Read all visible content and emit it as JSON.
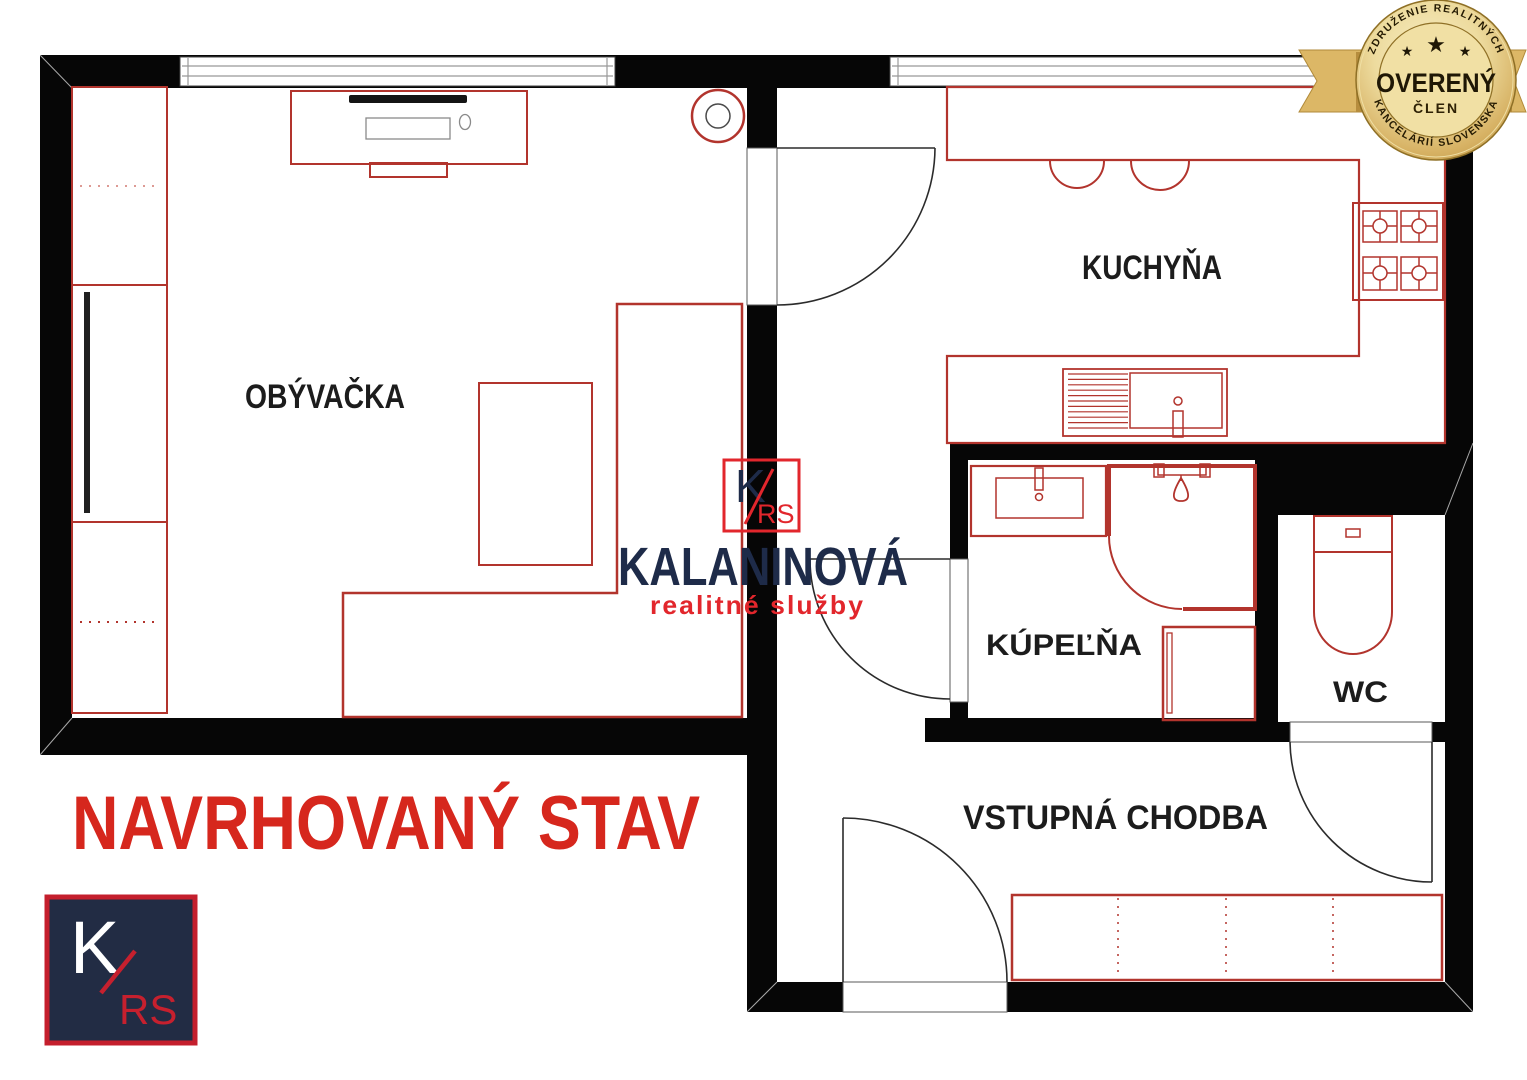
{
  "title": "NAVRHOVANÝ STAV",
  "rooms": {
    "living_room": "OBÝVAČKA",
    "kitchen": "KUCHYŇA",
    "bathroom": "KÚPEĽŇA",
    "wc": "WC",
    "hallway": "VSTUPNÁ CHODBA"
  },
  "brand": {
    "monogram_k": "K",
    "monogram_rs": "RS",
    "name": "KALANINOVÁ",
    "tagline": "realitné služby"
  },
  "badge": {
    "arc_top": "ZDRUŽENIE REALITNÝCH",
    "main": "OVERENÝ",
    "member": "ČLEN",
    "arc_bottom": "KANCELÁRIÍ SLOVENSKA",
    "star": "★"
  },
  "colors": {
    "wall": "#060606",
    "fixture_red": "#b2342d",
    "fixture_red_light": "#dd9a94",
    "title_red": "#d6271d",
    "label_black": "#1c1c1c",
    "brand_navy": "#1e2b49",
    "brand_red": "#e2262c",
    "logo_bg": "#222c44",
    "logo_border": "#c41f2d",
    "badge_gold": "#d9b05c",
    "badge_text": "#241a02",
    "door_line": "#2b2b2b",
    "glass_gray": "#8a8a8a"
  }
}
